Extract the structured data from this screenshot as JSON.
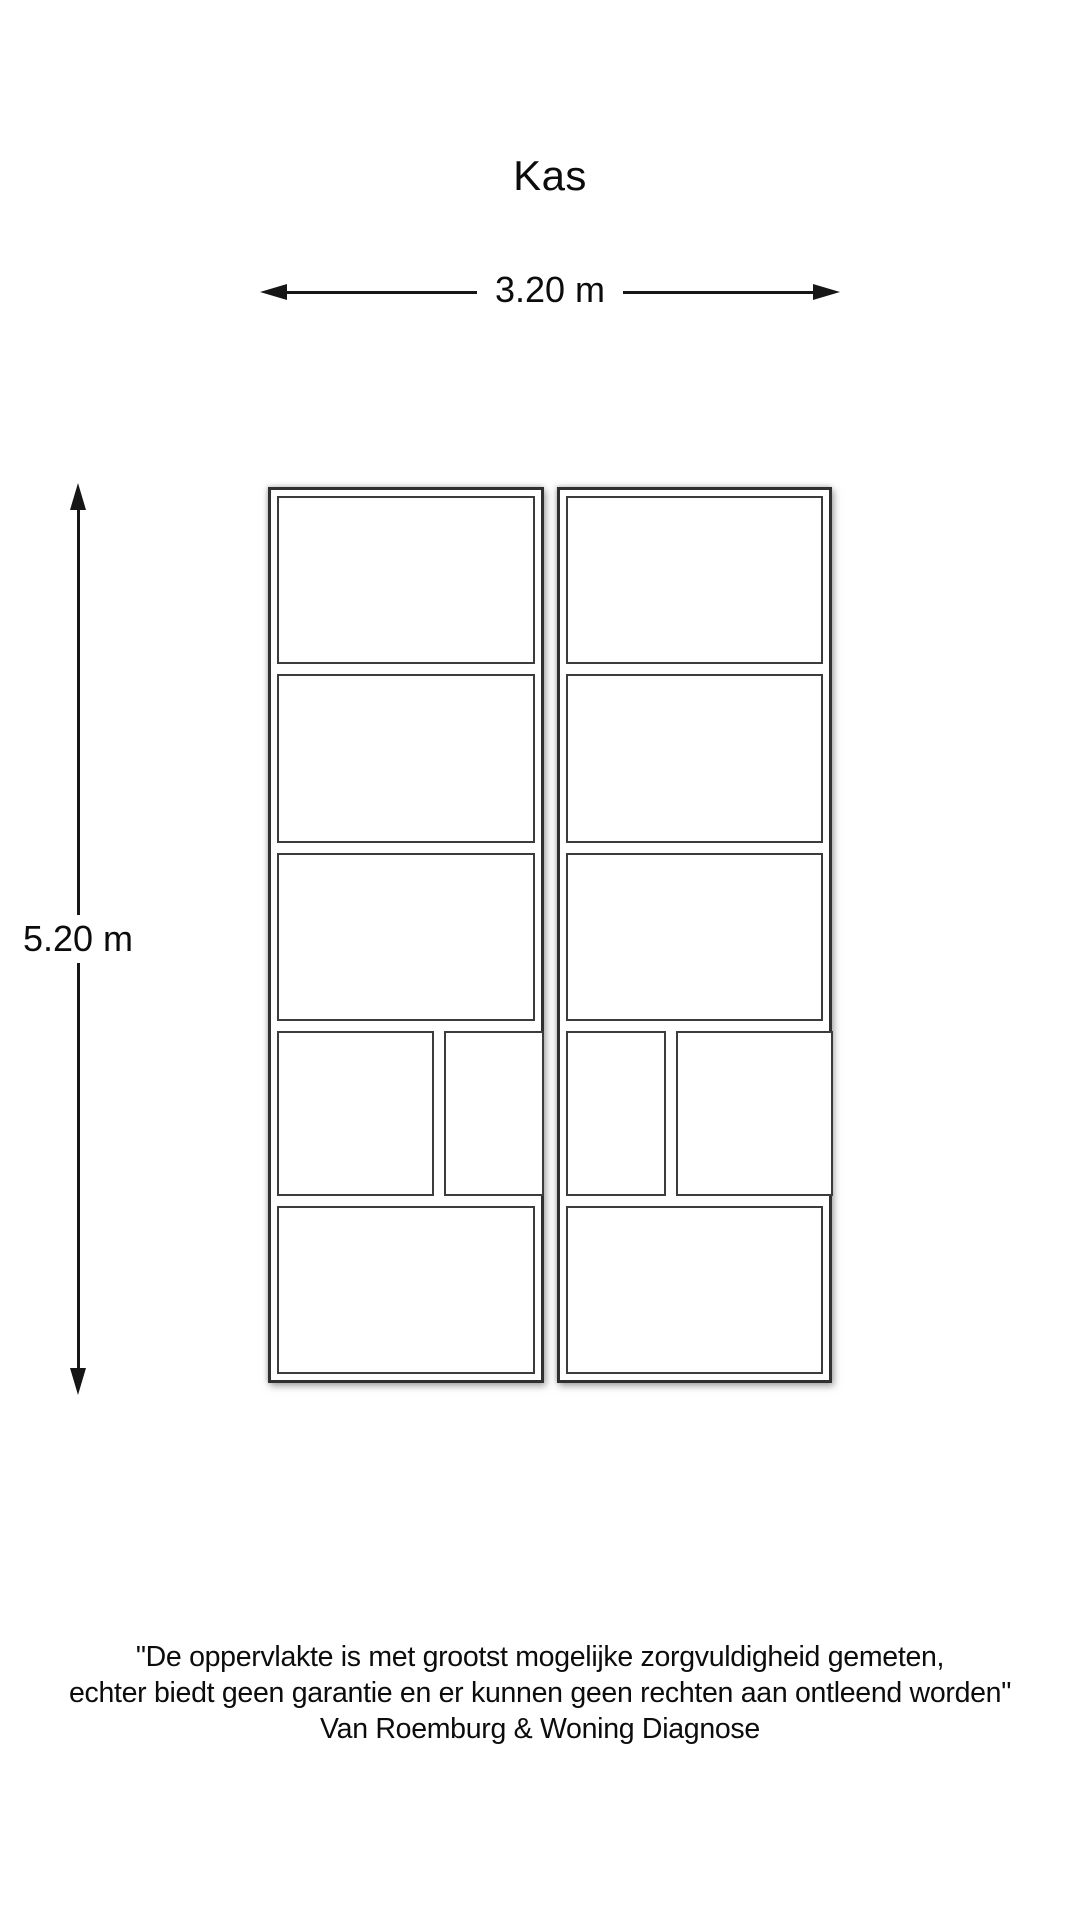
{
  "title": "Kas",
  "dimensions": {
    "width_label": "3.20 m",
    "height_label": "5.20 m"
  },
  "plan": {
    "room_name": "Kas",
    "columns": 2,
    "rows_per_column": 5,
    "split_row_index": 4,
    "shape": "rectangle"
  },
  "footer": {
    "disclaimer_line1": "\"De oppervlakte is met grootst mogelijke zorgvuldigheid gemeten,",
    "disclaimer_line2": "echter biedt geen garantie en er kunnen geen rechten aan ontleend worden\"",
    "company": "Van Roemburg & Woning Diagnose"
  }
}
